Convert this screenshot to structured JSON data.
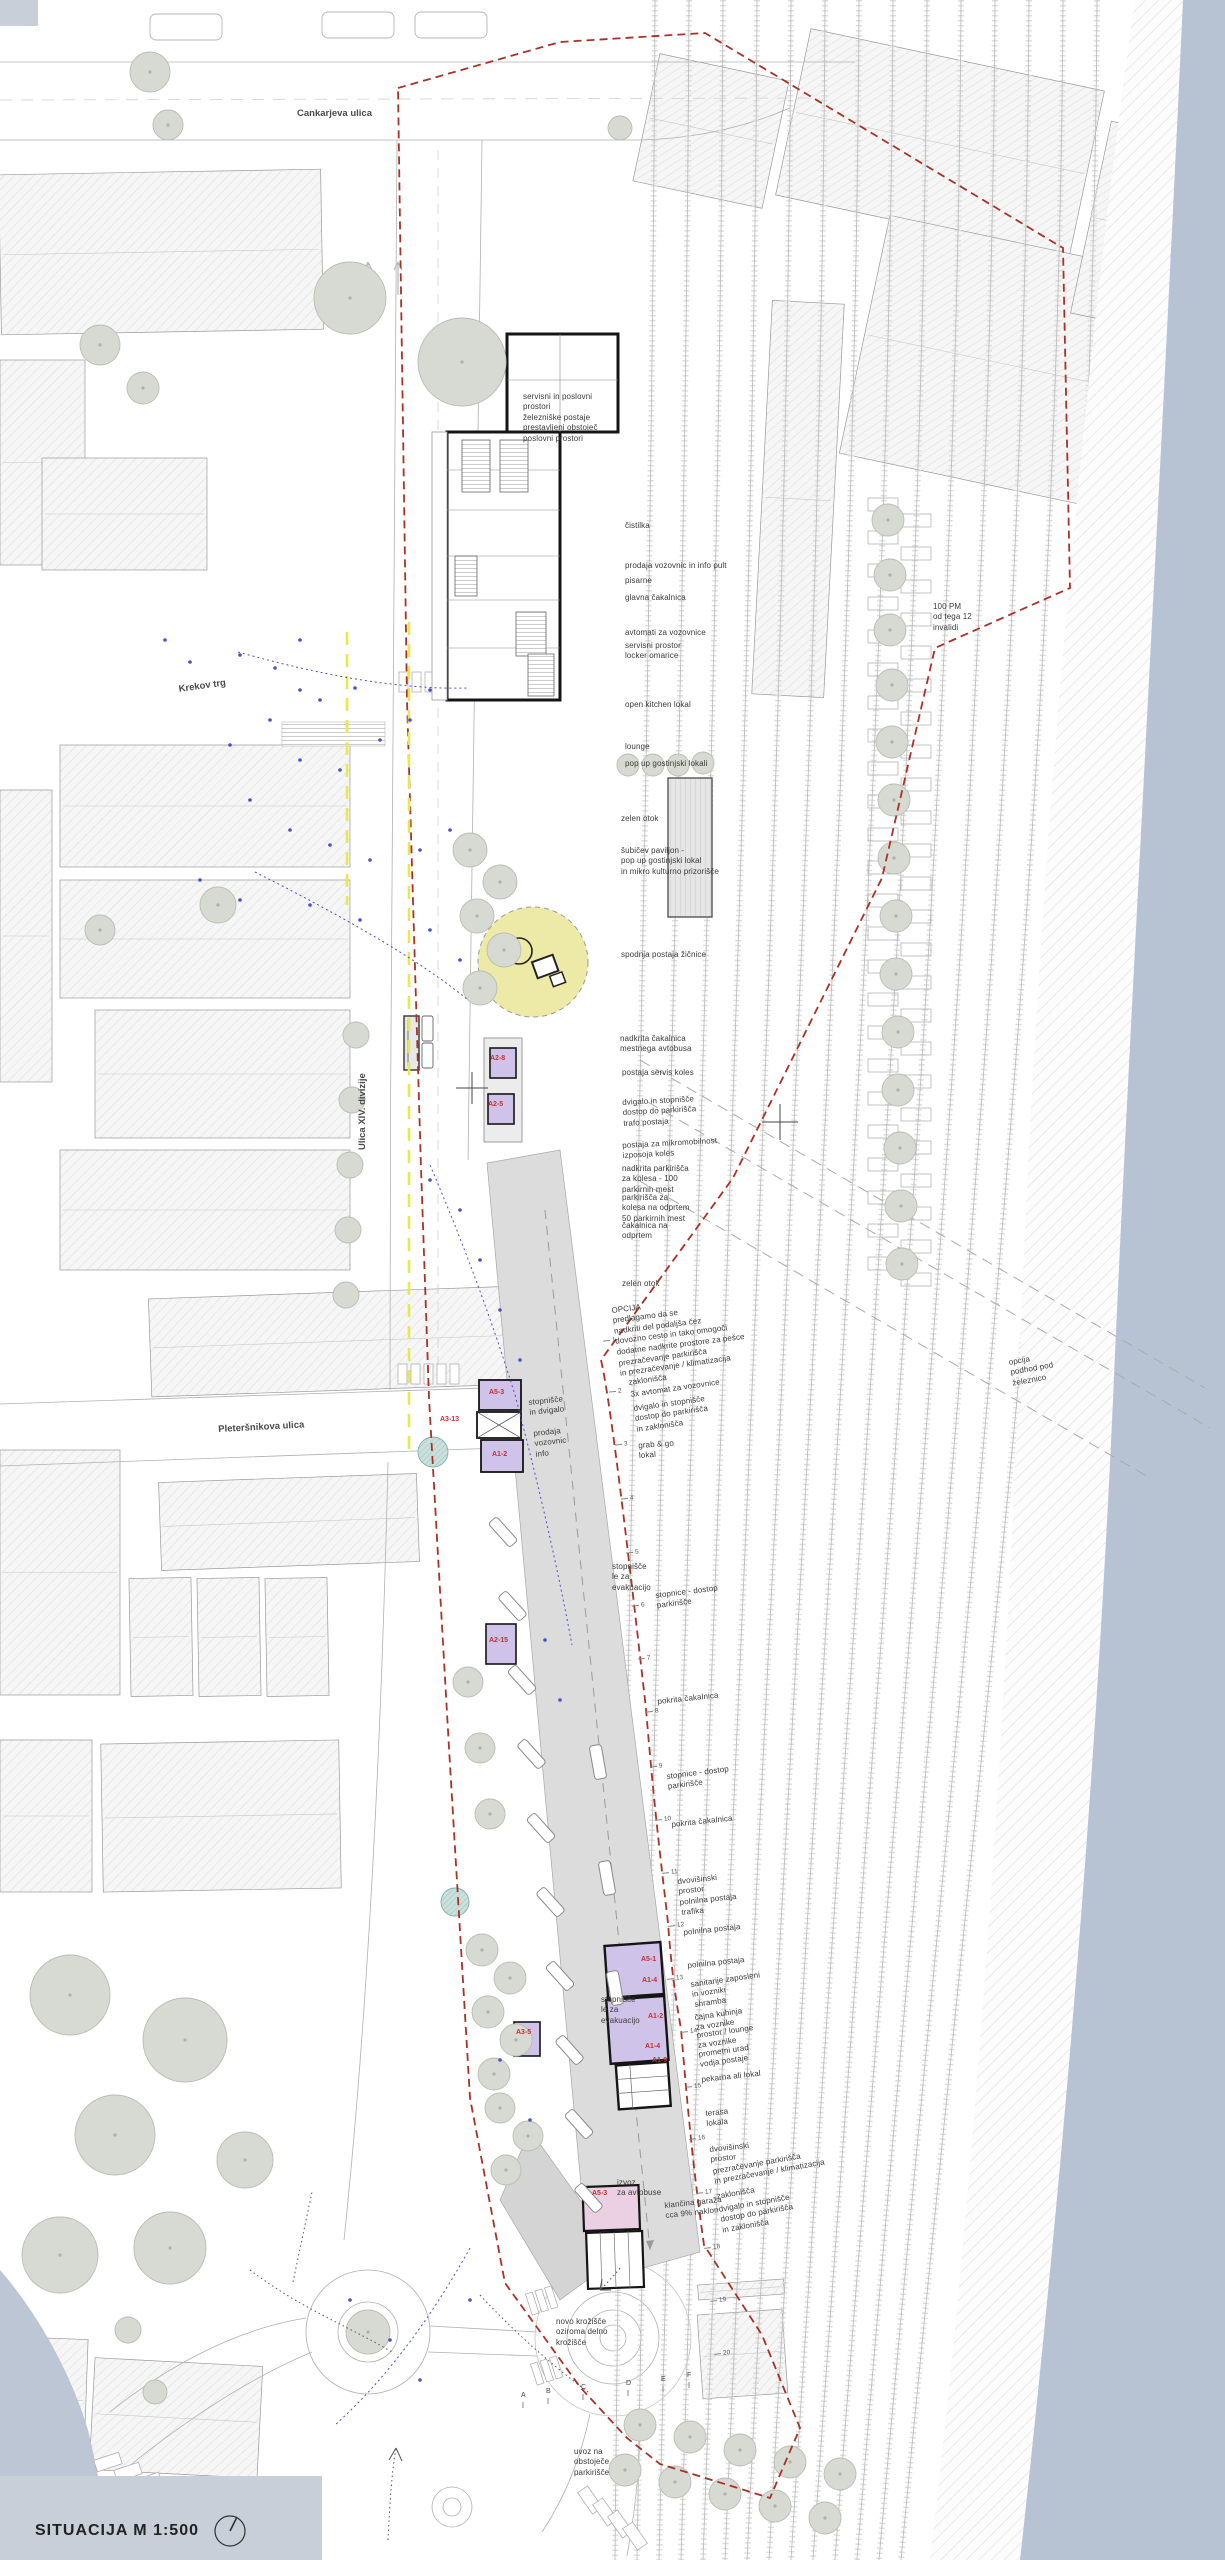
{
  "meta": {
    "title": "SITUACIJA  M 1:500"
  },
  "colors": {
    "boundary_red": "#a83226",
    "bus_lane_yellow": "#e8e84d",
    "river_blue": "#b7c2d3",
    "funicular_yellow": "#ede9a6",
    "kiosk_purple": "#cfc3ea",
    "kiosk_pink": "#ead0e2",
    "unit_label_red": "#c03030",
    "tree_green": "#d7dad2",
    "people_blue": "#4a50c8"
  },
  "streets": [
    {
      "label": "Cankarjeva ulica",
      "x": 297,
      "y": 108,
      "rot": 0
    },
    {
      "label": "Krekov trg",
      "x": 178,
      "y": 684,
      "rot": -8
    },
    {
      "label": "Pleteršnikova ulica",
      "x": 218,
      "y": 1424,
      "rot": -3
    },
    {
      "label": "Ulica XIV. divizije",
      "x": 357,
      "y": 1150,
      "rot": -90
    }
  ],
  "annotations": [
    {
      "t": "servisni in poslovni\nprostori\nželezniške postaje\nprestavljeni obstoječ\nposlovni prostori",
      "x": 523,
      "y": 392,
      "rot": 0
    },
    {
      "t": "čistilka",
      "x": 625,
      "y": 521,
      "rot": 0
    },
    {
      "t": "prodaja vozovnic in info pult",
      "x": 625,
      "y": 561,
      "rot": 0
    },
    {
      "t": "pisarne",
      "x": 625,
      "y": 576,
      "rot": 0
    },
    {
      "t": "glavna čakalnica",
      "x": 625,
      "y": 593,
      "rot": 0
    },
    {
      "t": "avtomati za vozovnice",
      "x": 625,
      "y": 628,
      "rot": 0
    },
    {
      "t": "servisni prostor\nlocker omarice",
      "x": 625,
      "y": 641,
      "rot": 0
    },
    {
      "t": "open kitchen lokal",
      "x": 625,
      "y": 700,
      "rot": 0
    },
    {
      "t": "lounge",
      "x": 625,
      "y": 742,
      "rot": 0
    },
    {
      "t": "pop up gostinjski lokali",
      "x": 625,
      "y": 759,
      "rot": 0
    },
    {
      "t": "zelen otok",
      "x": 621,
      "y": 814,
      "rot": 0
    },
    {
      "t": "šubičev paviljon -\npop up gostinjski lokal\nin mikro kulturno prizorišče",
      "x": 621,
      "y": 846,
      "rot": 0
    },
    {
      "t": "spodnja postaja žičnice",
      "x": 621,
      "y": 950,
      "rot": 0
    },
    {
      "t": "nadkrita čakalnica\nmestnega avtobusa",
      "x": 620,
      "y": 1034,
      "rot": 0
    },
    {
      "t": "postaja servis koles",
      "x": 622,
      "y": 1068,
      "rot": 0
    },
    {
      "t": "dvigalo in stopnišče\ndostop do parkirišča\ntrafo postaja",
      "x": 622,
      "y": 1098,
      "rot": -3
    },
    {
      "t": "postaja za mikromobilnost\nizposoja koles",
      "x": 622,
      "y": 1141,
      "rot": -3
    },
    {
      "t": "nadkrita parkirišča\nza kolesa - 100\nparkirnih mest",
      "x": 622,
      "y": 1164,
      "rot": 0
    },
    {
      "t": "parkirišča za\nkolesa na odprtem\n50 parkirnih mest",
      "x": 622,
      "y": 1193,
      "rot": 0
    },
    {
      "t": "čakalnica na\nodprtem",
      "x": 622,
      "y": 1221,
      "rot": 0
    },
    {
      "t": "zelen otok",
      "x": 622,
      "y": 1279,
      "rot": 0
    },
    {
      "t": "OPCIJA\npredlagamo da se\nnadkriti del podaljša čez\ndovozno cesto in tako omogoči\ndodatne nadkrite prostore za pešce",
      "x": 611,
      "y": 1306,
      "rot": -7
    },
    {
      "t": "prezračevanje parkirišča\nin prezračevanje / klimatizacija",
      "x": 618,
      "y": 1359,
      "rot": -8
    },
    {
      "t": "zaklonišča",
      "x": 628,
      "y": 1378,
      "rot": -8
    },
    {
      "t": "3x avtomat za vozovnice",
      "x": 630,
      "y": 1390,
      "rot": -8
    },
    {
      "t": "dvigalo in stopnišče\ndostop do parkirišča\nin zaklonišča",
      "x": 633,
      "y": 1404,
      "rot": -8
    },
    {
      "t": "grab & go\nlokal",
      "x": 638,
      "y": 1441,
      "rot": -4
    },
    {
      "t": "stopnišče\nle za\nevakuacijo",
      "x": 612,
      "y": 1562,
      "rot": 0
    },
    {
      "t": "stopnice - dostop\nparkirišče",
      "x": 655,
      "y": 1591,
      "rot": -7
    },
    {
      "t": "pokrita čakalnica",
      "x": 657,
      "y": 1697,
      "rot": -6
    },
    {
      "t": "stopnice - dostop\nparkirišče",
      "x": 666,
      "y": 1772,
      "rot": -7
    },
    {
      "t": "pokrita čakalnica",
      "x": 671,
      "y": 1820,
      "rot": -6
    },
    {
      "t": "dvovišinski\nprostor\npolnilna postaja",
      "x": 677,
      "y": 1877,
      "rot": -6
    },
    {
      "t": "trafika",
      "x": 681,
      "y": 1908,
      "rot": -6
    },
    {
      "t": "polnilna postaja",
      "x": 683,
      "y": 1928,
      "rot": -6
    },
    {
      "t": "polnilna postaja",
      "x": 687,
      "y": 1961,
      "rot": -6
    },
    {
      "t": "sanitarije zaposleni\nin vozniki",
      "x": 690,
      "y": 1980,
      "rot": -8
    },
    {
      "t": "shramba",
      "x": 694,
      "y": 2000,
      "rot": -8
    },
    {
      "t": "čajna kuhinja\nza voznike",
      "x": 694,
      "y": 2013,
      "rot": -8
    },
    {
      "t": "prostor / lounge\nza voznike",
      "x": 696,
      "y": 2031,
      "rot": -8
    },
    {
      "t": "prometni urad\nvodja postaje",
      "x": 698,
      "y": 2050,
      "rot": -8
    },
    {
      "t": "pekarna ali lokal",
      "x": 701,
      "y": 2075,
      "rot": -6
    },
    {
      "t": "terasa\nlokala",
      "x": 705,
      "y": 2109,
      "rot": -6
    },
    {
      "t": "dvovišinski\nprostor",
      "x": 709,
      "y": 2145,
      "rot": -6
    },
    {
      "t": "prezračevanje parkirišča\nin prezračevanje / klimatizacija",
      "x": 712,
      "y": 2167,
      "rot": -10
    },
    {
      "t": "zaklonišča",
      "x": 716,
      "y": 2192,
      "rot": -10
    },
    {
      "t": "klančina garaža\ncca 9% naklon",
      "x": 664,
      "y": 2201,
      "rot": -6
    },
    {
      "t": "dvigalo in stopnišče\ndostop do parkirišča\nin zaklonišča",
      "x": 718,
      "y": 2205,
      "rot": -10
    },
    {
      "t": "izvoz\nza avtobuse",
      "x": 617,
      "y": 2178,
      "rot": 0
    },
    {
      "t": "stopnišče\nle za\nevakuacijo",
      "x": 601,
      "y": 1995,
      "rot": 0
    },
    {
      "t": "stopnišče\nin dvigalo",
      "x": 528,
      "y": 1398,
      "rot": -6
    },
    {
      "t": "prodaja\nvozovnic\ninfo",
      "x": 533,
      "y": 1429,
      "rot": -6
    },
    {
      "t": "novo krožišče\noziroma delno\nkrožišče",
      "x": 556,
      "y": 2317,
      "rot": 0
    },
    {
      "t": "uvoz na\nobstoječe\nparkirišče",
      "x": 574,
      "y": 2447,
      "rot": 0
    },
    {
      "t": "100 PM\nod tega 12\ninvalidi",
      "x": 933,
      "y": 602,
      "rot": 0
    },
    {
      "t": "opcija\npodhod pod\nželeznico",
      "x": 1008,
      "y": 1358,
      "rot": -10
    }
  ],
  "unit_labels": [
    {
      "label": "A2-8",
      "x": 490,
      "y": 1055
    },
    {
      "label": "A2-5",
      "x": 488,
      "y": 1101
    },
    {
      "label": "A5-3",
      "x": 489,
      "y": 1389
    },
    {
      "label": "A3-13",
      "x": 440,
      "y": 1416
    },
    {
      "label": "A1-2",
      "x": 492,
      "y": 1451
    },
    {
      "label": "A2-15",
      "x": 489,
      "y": 1637
    },
    {
      "label": "A5-1",
      "x": 641,
      "y": 1956
    },
    {
      "label": "A1-4",
      "x": 642,
      "y": 1977
    },
    {
      "label": "A1-2",
      "x": 648,
      "y": 2013
    },
    {
      "label": "A1-4",
      "x": 645,
      "y": 2043
    },
    {
      "label": "A1-9",
      "x": 652,
      "y": 2057
    },
    {
      "label": "A3-5",
      "x": 516,
      "y": 2029
    },
    {
      "label": "A5-3",
      "x": 592,
      "y": 2190
    }
  ],
  "stop_numbers": [
    {
      "n": "1",
      "x": 603,
      "y": 1337
    },
    {
      "n": "2",
      "x": 609,
      "y": 1388
    },
    {
      "n": "3",
      "x": 615,
      "y": 1441
    },
    {
      "n": "4",
      "x": 621,
      "y": 1495
    },
    {
      "n": "5",
      "x": 626,
      "y": 1549
    },
    {
      "n": "6",
      "x": 632,
      "y": 1602
    },
    {
      "n": "7",
      "x": 638,
      "y": 1655
    },
    {
      "n": "8",
      "x": 646,
      "y": 1708
    },
    {
      "n": "9",
      "x": 650,
      "y": 1763
    },
    {
      "n": "10",
      "x": 655,
      "y": 1816
    },
    {
      "n": "11",
      "x": 662,
      "y": 1869
    },
    {
      "n": "12",
      "x": 668,
      "y": 1922
    },
    {
      "n": "13",
      "x": 667,
      "y": 1975
    },
    {
      "n": "14",
      "x": 681,
      "y": 2028
    },
    {
      "n": "15",
      "x": 685,
      "y": 2083
    },
    {
      "n": "16",
      "x": 689,
      "y": 2135
    },
    {
      "n": "17",
      "x": 696,
      "y": 2189
    },
    {
      "n": "18",
      "x": 704,
      "y": 2244
    },
    {
      "n": "19",
      "x": 710,
      "y": 2297
    },
    {
      "n": "20",
      "x": 714,
      "y": 2350
    }
  ],
  "platform_letters": [
    {
      "l": "A",
      "x": 521,
      "y": 2392
    },
    {
      "l": "B",
      "x": 546,
      "y": 2388
    },
    {
      "l": "C",
      "x": 581,
      "y": 2384
    },
    {
      "l": "D",
      "x": 626,
      "y": 2380
    },
    {
      "l": "E",
      "x": 661,
      "y": 2376
    },
    {
      "l": "F",
      "x": 687,
      "y": 2372
    }
  ]
}
